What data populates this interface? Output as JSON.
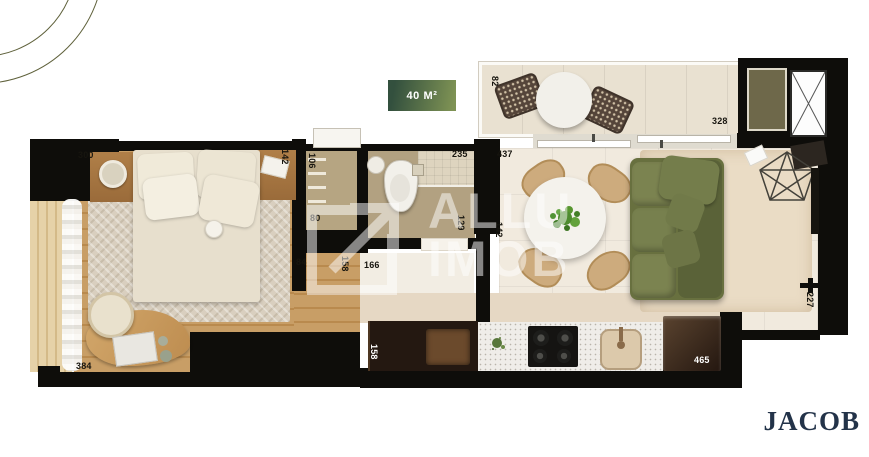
{
  "badge": {
    "label": "40 M²",
    "bg_from": "#33503e",
    "bg_to": "#7e9254"
  },
  "watermark": {
    "line1": "ALLU",
    "line2": "IMOB",
    "logo_icon": "arrow-up-right-square",
    "color": "#ffffff"
  },
  "brand": {
    "name": "JACOB",
    "color": "#233349"
  },
  "decor": {
    "arc_color": "#5f613b"
  },
  "plan": {
    "wall_color": "#0e0d0a",
    "sofa_color": "#68703f",
    "dims": {
      "bedroom_top": "300",
      "bedroom_right": "142",
      "bedroom_bottom": "384",
      "closet_side": "106",
      "closet_front": "80",
      "bath_top": "235",
      "bath_side": "129",
      "entry_a": "84",
      "entry_b": "158",
      "entry_c": "166",
      "balcony_side": "82",
      "balcony_bottom": "328",
      "living_top": "437",
      "living_left": "142",
      "living_right": "227",
      "kitchen_side": "158",
      "kitchen_bottom": "465"
    }
  }
}
